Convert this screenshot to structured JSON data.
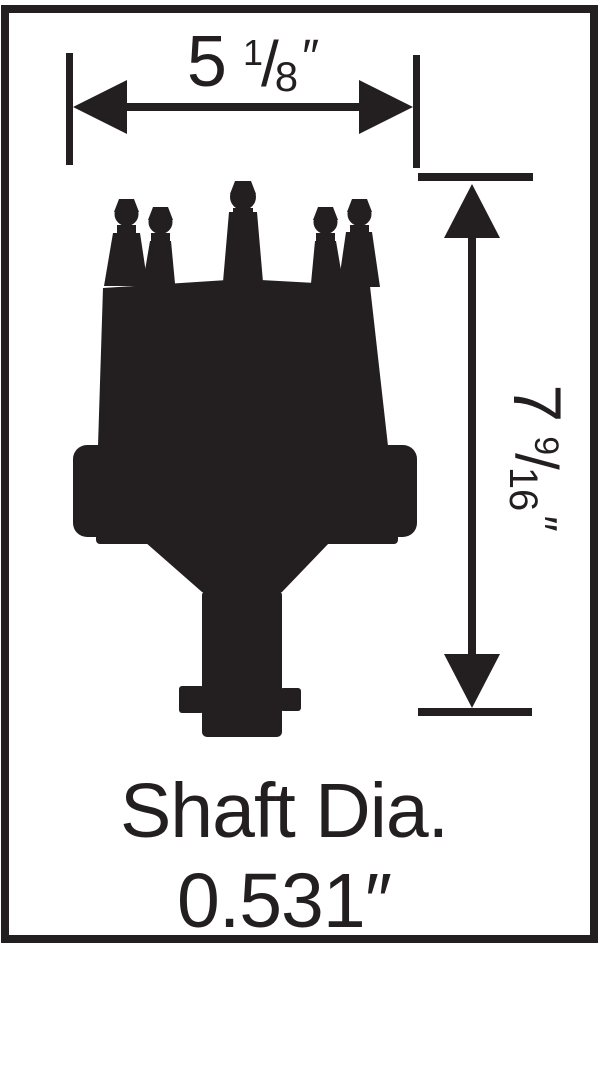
{
  "colors": {
    "ink": "#231f20",
    "background": "#ffffff"
  },
  "width_dimension": {
    "whole": "5",
    "numerator": "1",
    "slash": "/",
    "denominator": "8",
    "unit": "″"
  },
  "height_dimension": {
    "whole": "7",
    "numerator": "9",
    "slash": "/",
    "denominator": "16",
    "unit": "″"
  },
  "shaft_label": {
    "line1": "Shaft Dia.",
    "line2": "0.531″"
  }
}
